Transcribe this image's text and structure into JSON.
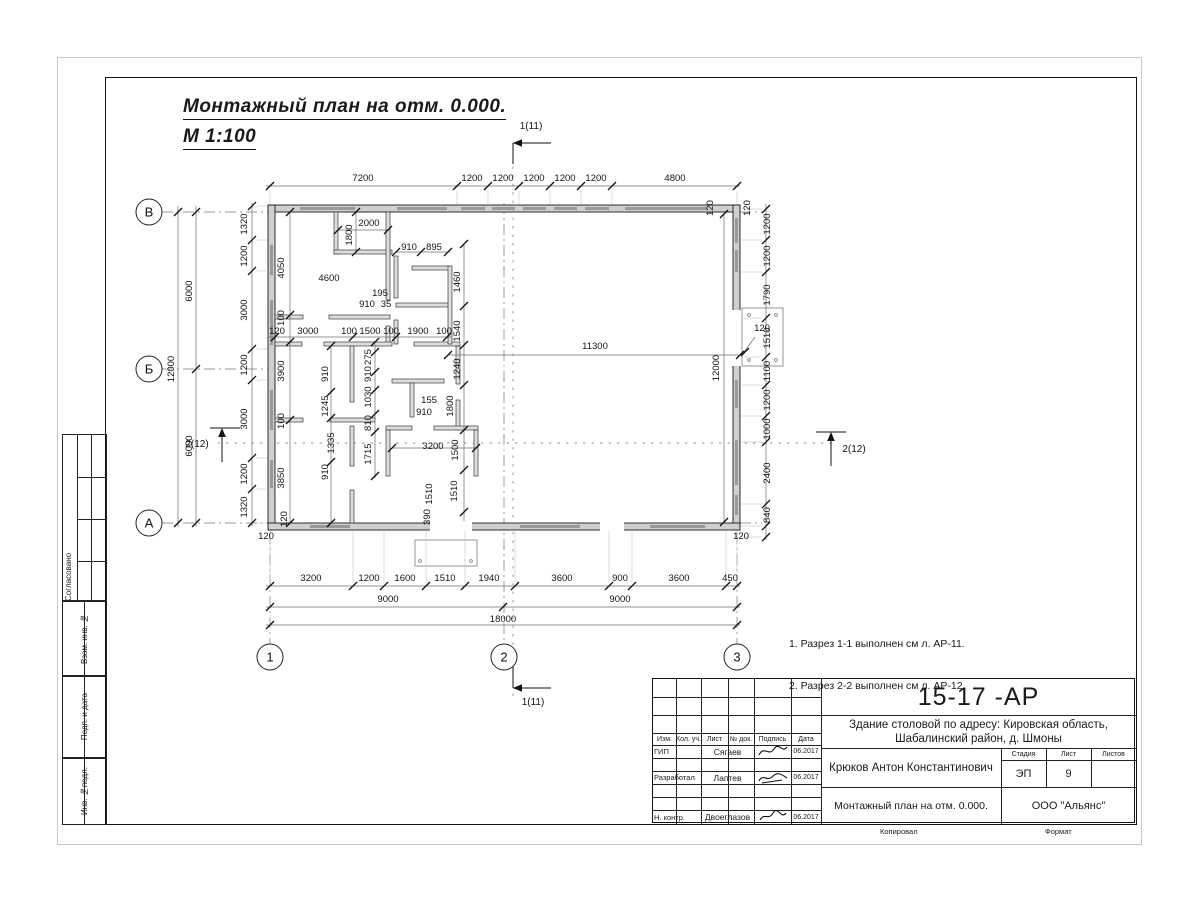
{
  "heading": {
    "line1": "Монтажный план на отм. 0.000.",
    "line2": "М 1:100"
  },
  "notes": {
    "items": [
      "1. Разрез 1-1 выполнен см л. АР-11.",
      "2. Разрез 2-2 выполнен см л. АР-12."
    ]
  },
  "margin": {
    "approved": "Согласовано",
    "replace_inv": "Взам. инв. №",
    "sign_date": "Подп. и дата",
    "inv_original": "Инв. №подл."
  },
  "title_block": {
    "doc_number": "15-17 -АР",
    "project_line1": "Здание столовой по адресу: Кировская область,",
    "project_line2": "Шабалинский район, д. Шмоны",
    "header_cols": {
      "izm": "Изм.",
      "kol": "Кол. уч.",
      "list": "Лист",
      "doc": "№ док.",
      "sign": "Подпись",
      "date": "Дата"
    },
    "rows": [
      {
        "role": "ГИП",
        "name": "Сягаев",
        "date": "06.2017"
      },
      {
        "role": "Разработал",
        "name": "Лаптев",
        "date": "06.2017"
      },
      {
        "role": "Н. контр.",
        "name": "Двоеглазов",
        "date": "06.2017"
      }
    ],
    "chief": "Крюков Антон Константинович",
    "sheet_title": "Монтажный план на отм. 0.000.",
    "stage_label": "Стадия",
    "sheet_label": "Лист",
    "sheets_label": "Листов",
    "stage": "ЭП",
    "sheet": "9",
    "sheets": "",
    "company": "ООО \"Альянс\"",
    "copied_label": "Копировал",
    "format_label": "Формат"
  },
  "plan": {
    "axis_rows": [
      {
        "t": "В",
        "x": 149,
        "y": 212
      },
      {
        "t": "Б",
        "x": 149,
        "y": 369
      },
      {
        "t": "А",
        "x": 149,
        "y": 523
      }
    ],
    "axis_cols": [
      {
        "t": "1",
        "x": 270,
        "y": 657
      },
      {
        "t": "2",
        "x": 504,
        "y": 657
      },
      {
        "t": "3",
        "x": 737,
        "y": 657
      }
    ],
    "section_markers": [
      {
        "t": "1(11)",
        "x": 531,
        "y": 129
      },
      {
        "t": "1(11)",
        "x": 533,
        "y": 705
      },
      {
        "t": "2(12)",
        "x": 197,
        "y": 447
      },
      {
        "t": "2(12)",
        "x": 854,
        "y": 452
      }
    ],
    "labels": [
      {
        "t": "7200",
        "x": 363,
        "y": 181
      },
      {
        "t": "1200",
        "x": 472,
        "y": 181
      },
      {
        "t": "1200",
        "x": 503,
        "y": 181
      },
      {
        "t": "1200",
        "x": 534,
        "y": 181
      },
      {
        "t": "1200",
        "x": 565,
        "y": 181
      },
      {
        "t": "1200",
        "x": 596,
        "y": 181
      },
      {
        "t": "4800",
        "x": 675,
        "y": 181
      },
      {
        "t": "120",
        "x": 713,
        "y": 208,
        "r": -90
      },
      {
        "t": "120",
        "x": 750,
        "y": 208,
        "r": -90
      },
      {
        "t": "1320",
        "x": 247,
        "y": 224,
        "r": -90
      },
      {
        "t": "1200",
        "x": 247,
        "y": 256,
        "r": -90
      },
      {
        "t": "3000",
        "x": 247,
        "y": 310,
        "r": -90
      },
      {
        "t": "1200",
        "x": 247,
        "y": 365,
        "r": -90
      },
      {
        "t": "3000",
        "x": 247,
        "y": 419,
        "r": -90
      },
      {
        "t": "1200",
        "x": 247,
        "y": 474,
        "r": -90
      },
      {
        "t": "1320",
        "x": 247,
        "y": 507,
        "r": -90
      },
      {
        "t": "6000",
        "x": 192,
        "y": 291,
        "r": -90
      },
      {
        "t": "6000",
        "x": 192,
        "y": 446,
        "r": -90
      },
      {
        "t": "12000",
        "x": 174,
        "y": 369,
        "r": -90
      },
      {
        "t": "1200",
        "x": 770,
        "y": 224,
        "r": -90
      },
      {
        "t": "1200",
        "x": 770,
        "y": 256,
        "r": -90
      },
      {
        "t": "1790",
        "x": 770,
        "y": 295,
        "r": -90
      },
      {
        "t": "1510",
        "x": 770,
        "y": 338,
        "r": -90
      },
      {
        "t": "1100",
        "x": 770,
        "y": 371,
        "r": -90
      },
      {
        "t": "1200",
        "x": 770,
        "y": 400,
        "r": -90
      },
      {
        "t": "1000",
        "x": 770,
        "y": 429,
        "r": -90
      },
      {
        "t": "2400",
        "x": 770,
        "y": 473,
        "r": -90
      },
      {
        "t": "840",
        "x": 770,
        "y": 515,
        "r": -90
      },
      {
        "t": "120",
        "x": 266,
        "y": 539
      },
      {
        "t": "120",
        "x": 741,
        "y": 539
      },
      {
        "t": "3200",
        "x": 311,
        "y": 581
      },
      {
        "t": "1200",
        "x": 369,
        "y": 581
      },
      {
        "t": "1600",
        "x": 405,
        "y": 581
      },
      {
        "t": "1510",
        "x": 445,
        "y": 581
      },
      {
        "t": "1940",
        "x": 489,
        "y": 581
      },
      {
        "t": "3600",
        "x": 562,
        "y": 581
      },
      {
        "t": "900",
        "x": 620,
        "y": 581
      },
      {
        "t": "3600",
        "x": 679,
        "y": 581
      },
      {
        "t": "450",
        "x": 730,
        "y": 581
      },
      {
        "t": "9000",
        "x": 388,
        "y": 602
      },
      {
        "t": "9000",
        "x": 620,
        "y": 602
      },
      {
        "t": "18000",
        "x": 503,
        "y": 622
      },
      {
        "t": "4050",
        "x": 284,
        "y": 268,
        "r": -90
      },
      {
        "t": "1800",
        "x": 352,
        "y": 235,
        "r": -90
      },
      {
        "t": "2000",
        "x": 369,
        "y": 226
      },
      {
        "t": "4600",
        "x": 329,
        "y": 281
      },
      {
        "t": "910",
        "x": 409,
        "y": 250
      },
      {
        "t": "895",
        "x": 434,
        "y": 250
      },
      {
        "t": "195",
        "x": 380,
        "y": 296
      },
      {
        "t": "910",
        "x": 367,
        "y": 307
      },
      {
        "t": "35",
        "x": 386,
        "y": 307
      },
      {
        "t": "1460",
        "x": 460,
        "y": 282,
        "r": -90
      },
      {
        "t": "100",
        "x": 284,
        "y": 318,
        "r": -90
      },
      {
        "t": "120",
        "x": 277,
        "y": 334
      },
      {
        "t": "3000",
        "x": 308,
        "y": 334
      },
      {
        "t": "100",
        "x": 349,
        "y": 334
      },
      {
        "t": "1500",
        "x": 370,
        "y": 334
      },
      {
        "t": "100",
        "x": 391,
        "y": 334
      },
      {
        "t": "1900",
        "x": 418,
        "y": 334
      },
      {
        "t": "100",
        "x": 444,
        "y": 334
      },
      {
        "t": "1540",
        "x": 460,
        "y": 331,
        "r": -90
      },
      {
        "t": "11300",
        "x": 595,
        "y": 349
      },
      {
        "t": "120",
        "x": 762,
        "y": 331
      },
      {
        "t": "12000",
        "x": 719,
        "y": 368,
        "r": -90
      },
      {
        "t": "3900",
        "x": 284,
        "y": 371,
        "r": -90
      },
      {
        "t": "910",
        "x": 328,
        "y": 374,
        "r": -90
      },
      {
        "t": "275",
        "x": 371,
        "y": 357,
        "r": -90
      },
      {
        "t": "910",
        "x": 371,
        "y": 374,
        "r": -90
      },
      {
        "t": "1240",
        "x": 460,
        "y": 369,
        "r": -90
      },
      {
        "t": "1030",
        "x": 371,
        "y": 397,
        "r": -90
      },
      {
        "t": "1245",
        "x": 328,
        "y": 406,
        "r": -90
      },
      {
        "t": "810",
        "x": 371,
        "y": 423,
        "r": -90
      },
      {
        "t": "155",
        "x": 429,
        "y": 403
      },
      {
        "t": "910",
        "x": 424,
        "y": 415
      },
      {
        "t": "1800",
        "x": 453,
        "y": 406,
        "r": -90
      },
      {
        "t": "100",
        "x": 284,
        "y": 421,
        "r": -90
      },
      {
        "t": "1335",
        "x": 334,
        "y": 443,
        "r": -90
      },
      {
        "t": "1715",
        "x": 371,
        "y": 454,
        "r": -90
      },
      {
        "t": "3200",
        "x": 433,
        "y": 449
      },
      {
        "t": "1500",
        "x": 458,
        "y": 450,
        "r": -90
      },
      {
        "t": "3850",
        "x": 284,
        "y": 478,
        "r": -90
      },
      {
        "t": "910",
        "x": 328,
        "y": 472,
        "r": -90
      },
      {
        "t": "1510",
        "x": 432,
        "y": 494,
        "r": -90
      },
      {
        "t": "1510",
        "x": 457,
        "y": 491,
        "r": -90
      },
      {
        "t": "390",
        "x": 430,
        "y": 517,
        "r": -90
      },
      {
        "t": "120",
        "x": 287,
        "y": 519,
        "r": -90
      }
    ]
  }
}
